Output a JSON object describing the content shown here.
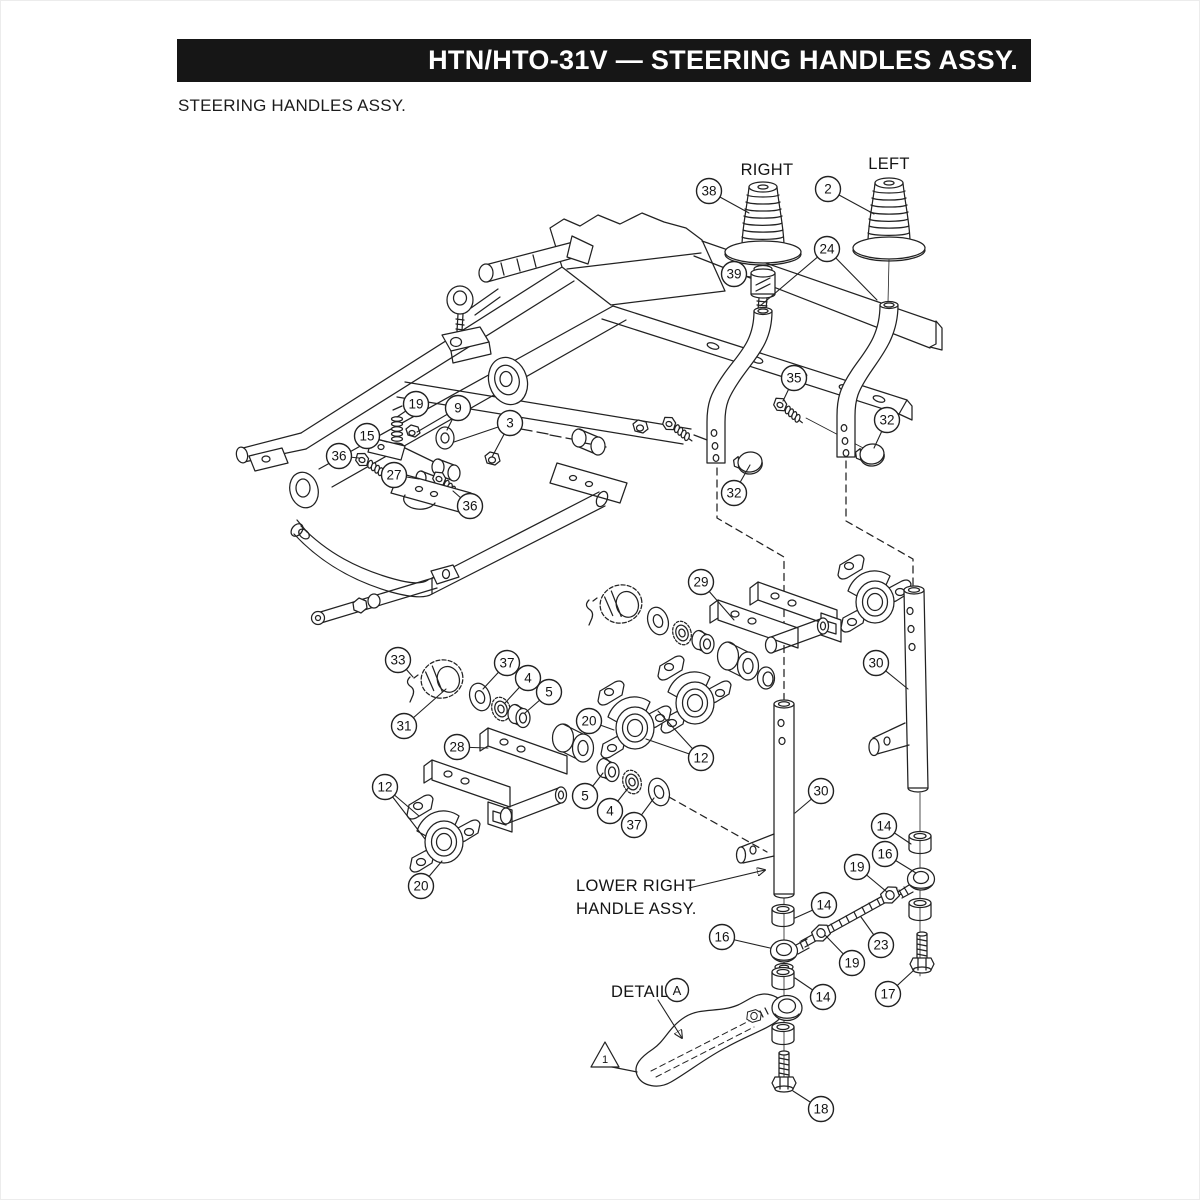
{
  "header": {
    "banner": "HTN/HTO-31V — STEERING HANDLES ASSY.",
    "subtitle": "STEERING HANDLES ASSY."
  },
  "drawing": {
    "labels": {
      "right": "RIGHT",
      "left": "LEFT",
      "lower_right_line1": "LOWER RIGHT",
      "lower_right_line2": "HANDLE ASSY.",
      "detail": "DETAIL",
      "detail_letter": "A",
      "note_number": "1"
    },
    "colors": {
      "ink": "#222222",
      "paper": "#ffffff",
      "banner_bg": "#161616",
      "banner_fg": "#ffffff"
    },
    "callouts": [
      {
        "n": "38",
        "x": 708,
        "y": 190,
        "t": [
          [
            748,
            212
          ]
        ]
      },
      {
        "n": "2",
        "x": 827,
        "y": 188,
        "t": [
          [
            873,
            213
          ]
        ]
      },
      {
        "n": "39",
        "x": 733,
        "y": 273,
        "t": [
          [
            750,
            276
          ]
        ]
      },
      {
        "n": "24",
        "x": 826,
        "y": 248,
        "t": [
          [
            759,
            305
          ],
          [
            876,
            299
          ]
        ]
      },
      {
        "n": "35",
        "x": 793,
        "y": 377,
        "t": [
          [
            782,
            400
          ]
        ]
      },
      {
        "n": "32",
        "x": 886,
        "y": 419,
        "t": [
          [
            873,
            447
          ]
        ]
      },
      {
        "n": "32",
        "x": 733,
        "y": 492,
        "t": [
          [
            749,
            464
          ]
        ]
      },
      {
        "n": "19",
        "x": 415,
        "y": 403,
        "t": [
          [
            396,
            416
          ]
        ]
      },
      {
        "n": "9",
        "x": 457,
        "y": 407,
        "t": [
          [
            446,
            429
          ],
          [
            416,
            431
          ]
        ]
      },
      {
        "n": "3",
        "x": 509,
        "y": 422,
        "t": [
          [
            453,
            441
          ],
          [
            491,
            456
          ]
        ]
      },
      {
        "n": "15",
        "x": 366,
        "y": 435,
        "t": [
          [
            386,
            441
          ]
        ]
      },
      {
        "n": "36",
        "x": 338,
        "y": 455,
        "t": [
          [
            358,
            457
          ]
        ]
      },
      {
        "n": "27",
        "x": 393,
        "y": 474,
        "t": [
          [
            418,
            478
          ]
        ]
      },
      {
        "n": "36",
        "x": 469,
        "y": 505,
        "t": [
          [
            452,
            490
          ]
        ]
      },
      {
        "n": "29",
        "x": 700,
        "y": 581,
        "t": [
          [
            733,
            619
          ]
        ]
      },
      {
        "n": "30",
        "x": 875,
        "y": 662,
        "t": [
          [
            907,
            688
          ]
        ]
      },
      {
        "n": "33",
        "x": 397,
        "y": 659,
        "t": [
          [
            412,
            676
          ]
        ]
      },
      {
        "n": "37",
        "x": 506,
        "y": 662,
        "t": [
          [
            482,
            688
          ]
        ]
      },
      {
        "n": "4",
        "x": 527,
        "y": 677,
        "t": [
          [
            504,
            702
          ]
        ]
      },
      {
        "n": "5",
        "x": 548,
        "y": 691,
        "t": [
          [
            524,
            712
          ]
        ]
      },
      {
        "n": "31",
        "x": 403,
        "y": 725,
        "t": [
          [
            445,
            688
          ]
        ]
      },
      {
        "n": "20",
        "x": 588,
        "y": 720,
        "t": [
          [
            613,
            729
          ]
        ]
      },
      {
        "n": "28",
        "x": 456,
        "y": 746,
        "t": [
          [
            487,
            747
          ]
        ]
      },
      {
        "n": "12",
        "x": 700,
        "y": 757,
        "t": [
          [
            657,
            710
          ],
          [
            645,
            738
          ]
        ]
      },
      {
        "n": "12",
        "x": 384,
        "y": 786,
        "t": [
          [
            418,
            815
          ],
          [
            424,
            838
          ]
        ]
      },
      {
        "n": "5",
        "x": 584,
        "y": 795,
        "t": [
          [
            602,
            772
          ]
        ]
      },
      {
        "n": "4",
        "x": 609,
        "y": 810,
        "t": [
          [
            628,
            786
          ]
        ]
      },
      {
        "n": "37",
        "x": 633,
        "y": 824,
        "t": [
          [
            653,
            797
          ]
        ]
      },
      {
        "n": "20",
        "x": 420,
        "y": 885,
        "t": [
          [
            441,
            860
          ]
        ]
      },
      {
        "n": "30",
        "x": 820,
        "y": 790,
        "t": [
          [
            794,
            812
          ]
        ]
      },
      {
        "n": "14",
        "x": 883,
        "y": 825,
        "t": [
          [
            910,
            843
          ]
        ]
      },
      {
        "n": "16",
        "x": 884,
        "y": 853,
        "t": [
          [
            915,
            872
          ]
        ]
      },
      {
        "n": "19",
        "x": 856,
        "y": 866,
        "t": [
          [
            886,
            891
          ]
        ]
      },
      {
        "n": "14",
        "x": 823,
        "y": 904,
        "t": [
          [
            794,
            917
          ]
        ]
      },
      {
        "n": "16",
        "x": 721,
        "y": 936,
        "t": [
          [
            769,
            947
          ]
        ]
      },
      {
        "n": "23",
        "x": 880,
        "y": 944,
        "t": [
          [
            860,
            916
          ]
        ]
      },
      {
        "n": "19",
        "x": 851,
        "y": 962,
        "t": [
          [
            824,
            934
          ]
        ]
      },
      {
        "n": "17",
        "x": 887,
        "y": 993,
        "t": [
          [
            913,
            969
          ]
        ]
      },
      {
        "n": "14",
        "x": 822,
        "y": 996,
        "t": [
          [
            794,
            977
          ]
        ]
      },
      {
        "n": "18",
        "x": 820,
        "y": 1108,
        "t": [
          [
            792,
            1090
          ]
        ]
      }
    ]
  }
}
